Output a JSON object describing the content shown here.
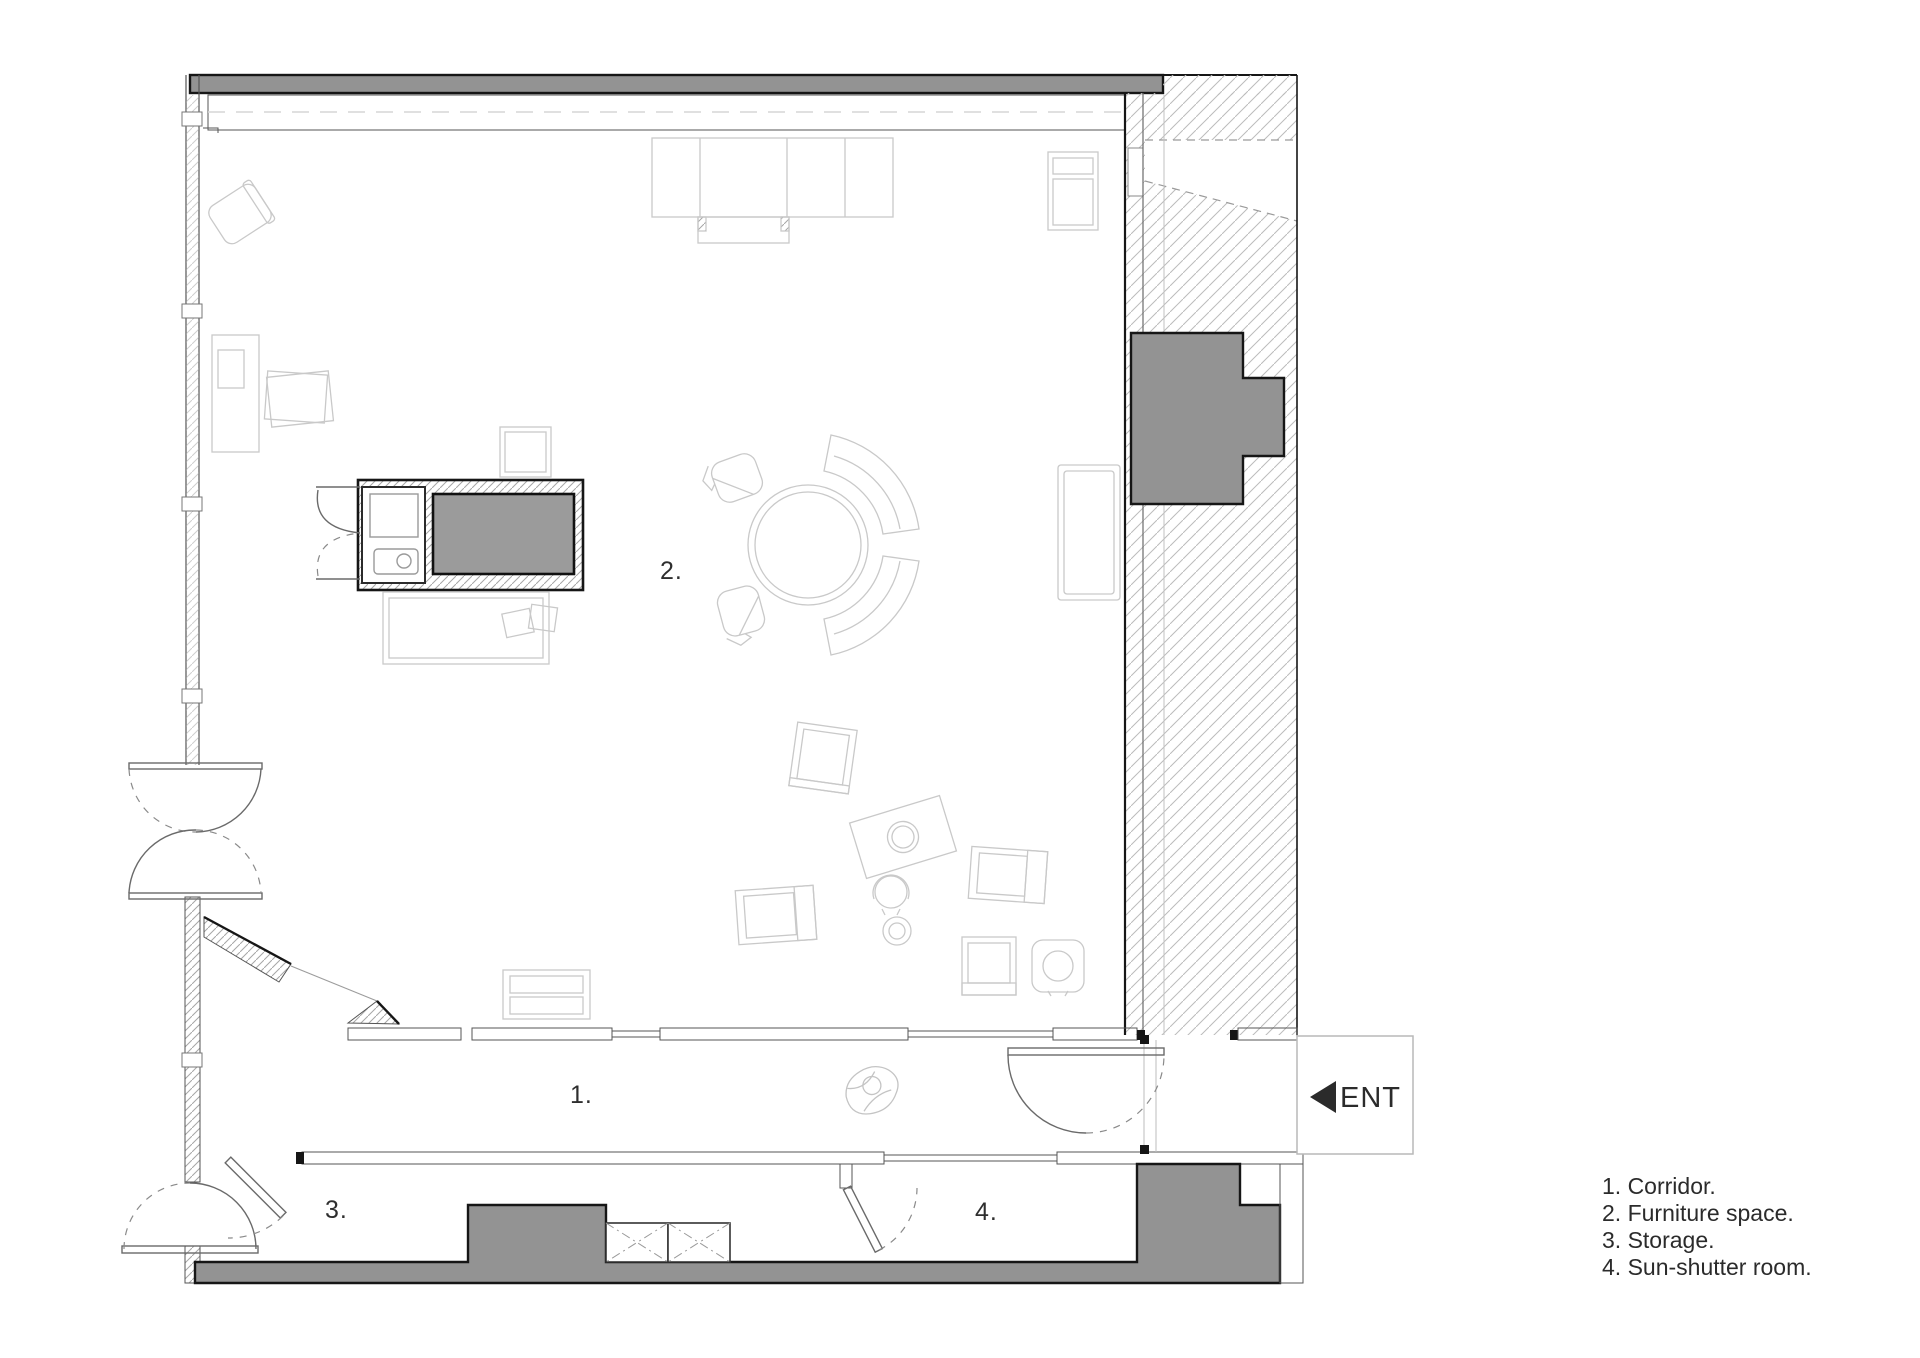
{
  "title": "Apartment floor plan",
  "rooms": {
    "labels": [
      {
        "id": "corridor",
        "text": "1."
      },
      {
        "id": "furniture-space",
        "text": "2."
      },
      {
        "id": "storage",
        "text": "3."
      },
      {
        "id": "sun-shutter",
        "text": "4."
      }
    ]
  },
  "entrance": {
    "label": "ENT"
  },
  "legend": {
    "items": [
      "1. Corridor.",
      "2. Furniture space.",
      "3. Storage.",
      "4. Sun-shutter room."
    ]
  },
  "colors": {
    "wall_dark": "#939393",
    "outline": "#161616",
    "hatch_light": "#bcbcbc",
    "hatch_dense": "#a6a6a6",
    "furniture_line": "#c9c9c9",
    "door_line": "#6a6a6a",
    "text": "#2b2b2b"
  }
}
